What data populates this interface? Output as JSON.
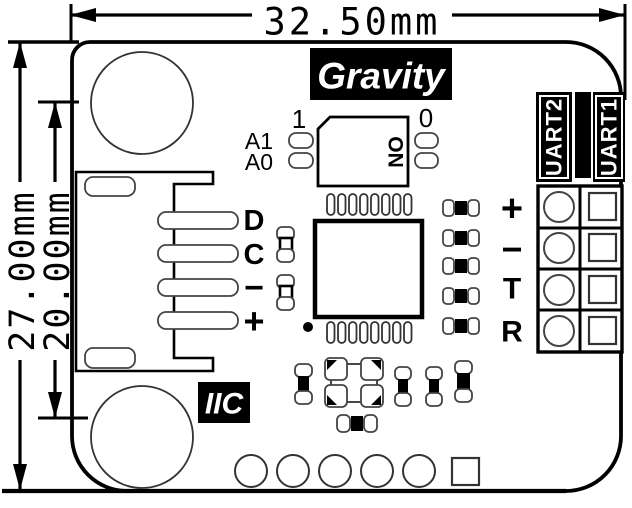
{
  "dimensions": {
    "width": "32.50mm",
    "height_outer": "27.00mm",
    "height_inner": "20.00mm"
  },
  "labels": {
    "brand": "Gravity",
    "iic": "IIC",
    "uart2": "UART2",
    "uart1": "UART1",
    "switch_on": "ON",
    "switch_pos_1": "1",
    "switch_pos_0": "0",
    "addr_a1": "A1",
    "addr_a0": "A0"
  },
  "iic_pins": [
    "D",
    "C",
    "−",
    "+"
  ],
  "uart_pins": [
    "+",
    "−",
    "T",
    "R"
  ],
  "colors": {
    "silkscreen": "#000000",
    "pad_stroke": "#444444",
    "background": "#ffffff"
  }
}
